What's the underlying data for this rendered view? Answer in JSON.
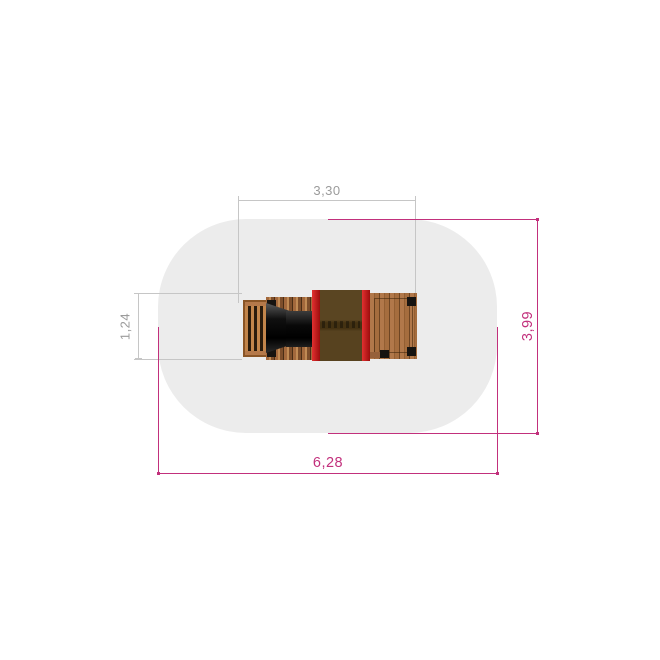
{
  "diagram": {
    "type": "plan-view-drawing",
    "dimension_labels": {
      "top_width": "3,30",
      "left_height": "1,24",
      "bottom_width": "6,28",
      "right_height": "3,99"
    },
    "colors": {
      "dim_primary": "#c2307c",
      "dim_secondary_line": "#c6c6c6",
      "dim_secondary_text": "#9b9b9b",
      "safety_zone": "#ececec",
      "wood_light": "#b1784a",
      "wood_dark": "#7d4e2b",
      "accent_red": "#d01818",
      "tower_brown": "#57421f",
      "tunnel_black": "#0c0c0c",
      "post_black": "#161310"
    }
  }
}
